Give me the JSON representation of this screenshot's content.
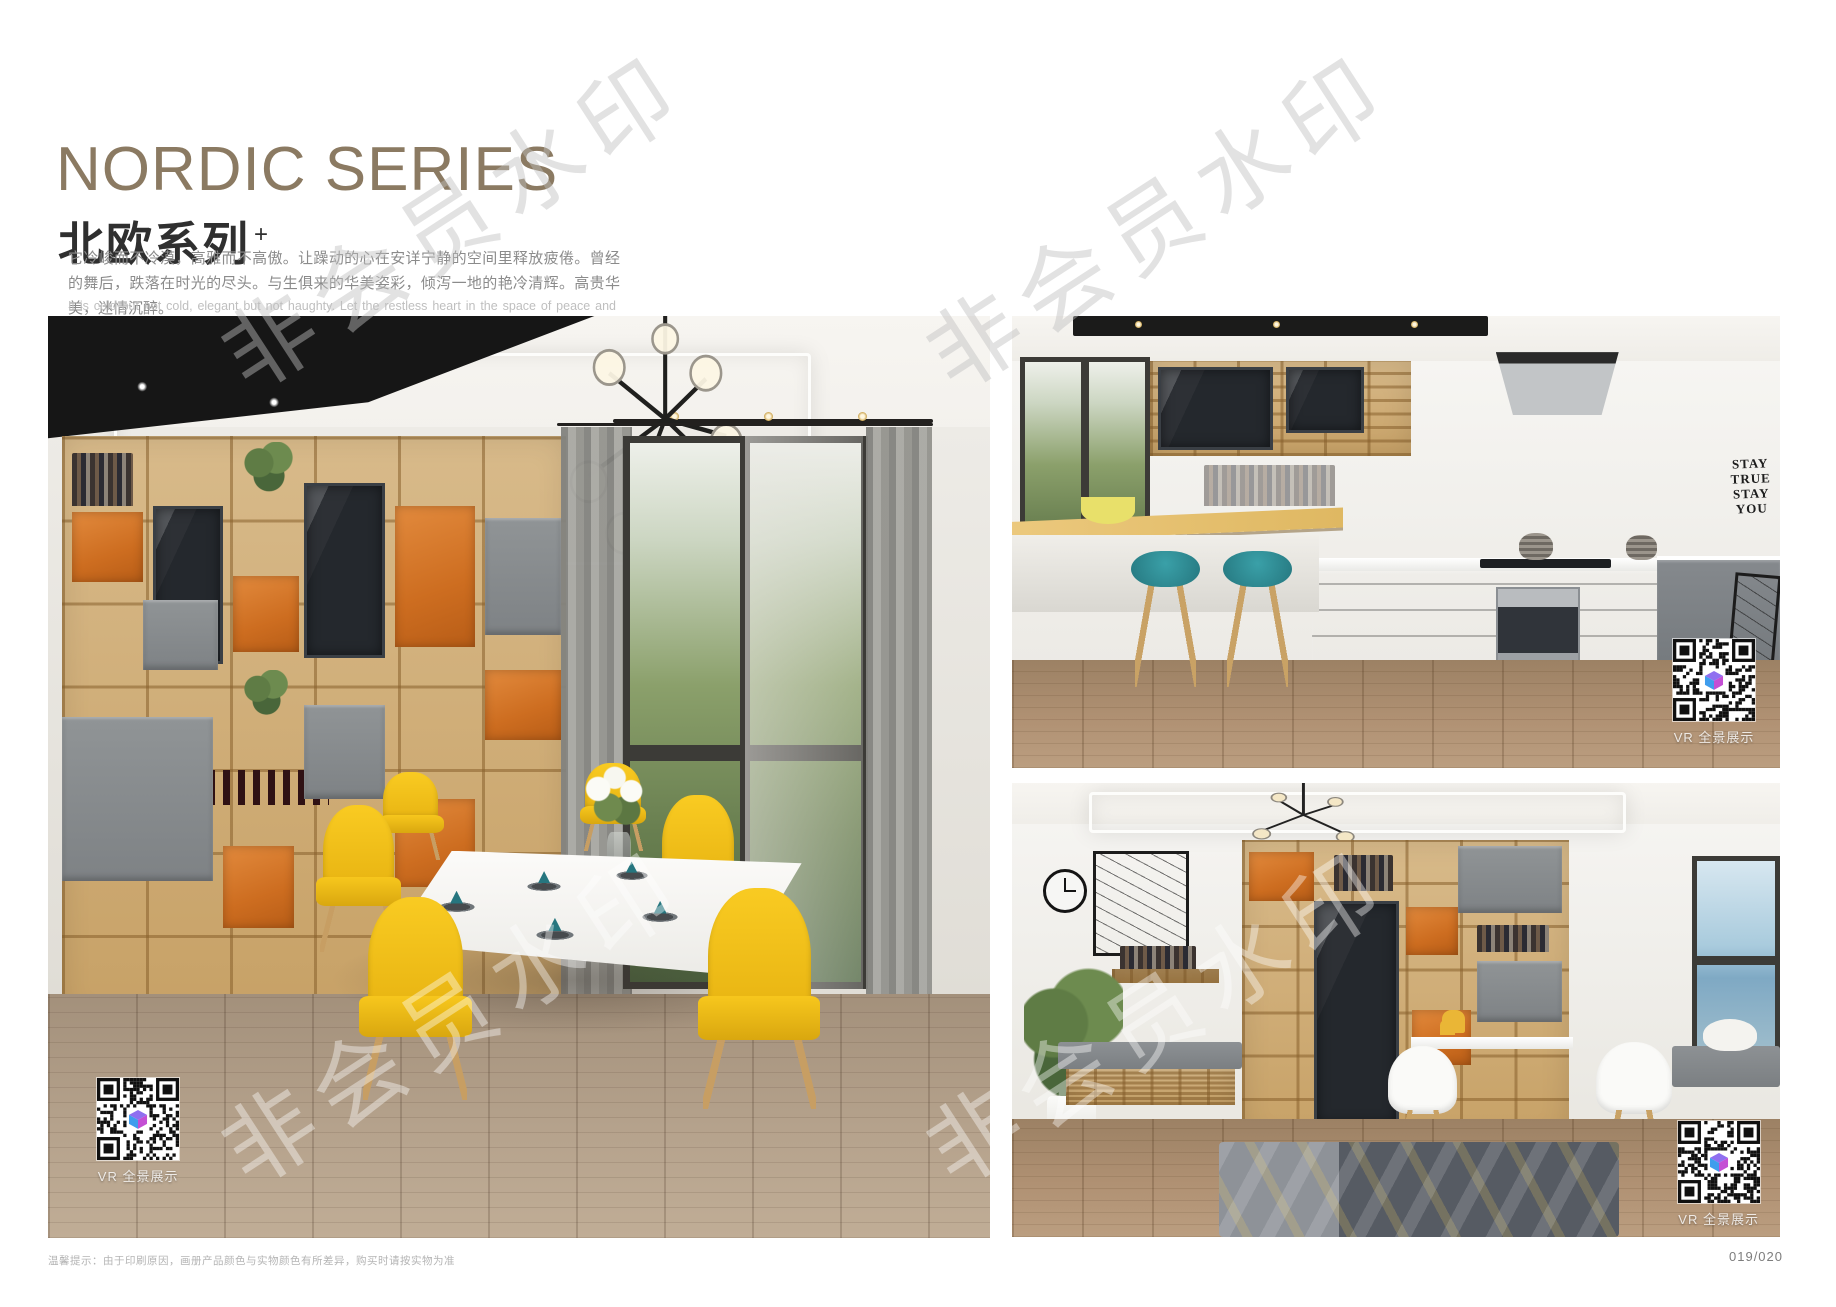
{
  "page": {
    "footer_note": "温馨提示：由于印刷原因，画册产品颜色与实物颜色有所差异，购买时请按实物为准",
    "page_number": "019/020"
  },
  "watermark": {
    "text": "非会员水印"
  },
  "header": {
    "title_en": "NORDIC SERIES",
    "title_cn": "北欧系列",
    "title_sup": "+",
    "title_color": "#8b7a62",
    "desc_cn": "它冷峻而不冷漠，高雅而不高傲。让躁动的心在安详宁静的空间里释放疲倦。曾经的舞后，跌落在时光的尽头。与生俱来的华美姿彩，倾泻一地的艳冷清辉。高贵华美，迷情沉醉。",
    "desc_en": "It is cold but not cold, elegant but not haughty. Let the restless heart in the space of peace and tranquility release fatigue. Once the Queen of Dance, fall in the end of time. The natural beauty of the beautiful, pouring a land of cold and pure brilliance. Noble, beautiful, enchanted."
  },
  "palette": {
    "accent_orange": "#cd6d20",
    "accent_yellow": "#f2bd16",
    "accent_teal": "#2f8f97",
    "wood": "#c7a166"
  },
  "photos": {
    "dining": {
      "vr_label": "VR 全景展示"
    },
    "kitchen": {
      "vr_label": "VR 全景展示",
      "wall_text": [
        "STAY",
        "TRUE",
        "STAY",
        "YOU"
      ]
    },
    "study": {
      "vr_label": "VR 全景展示"
    }
  }
}
